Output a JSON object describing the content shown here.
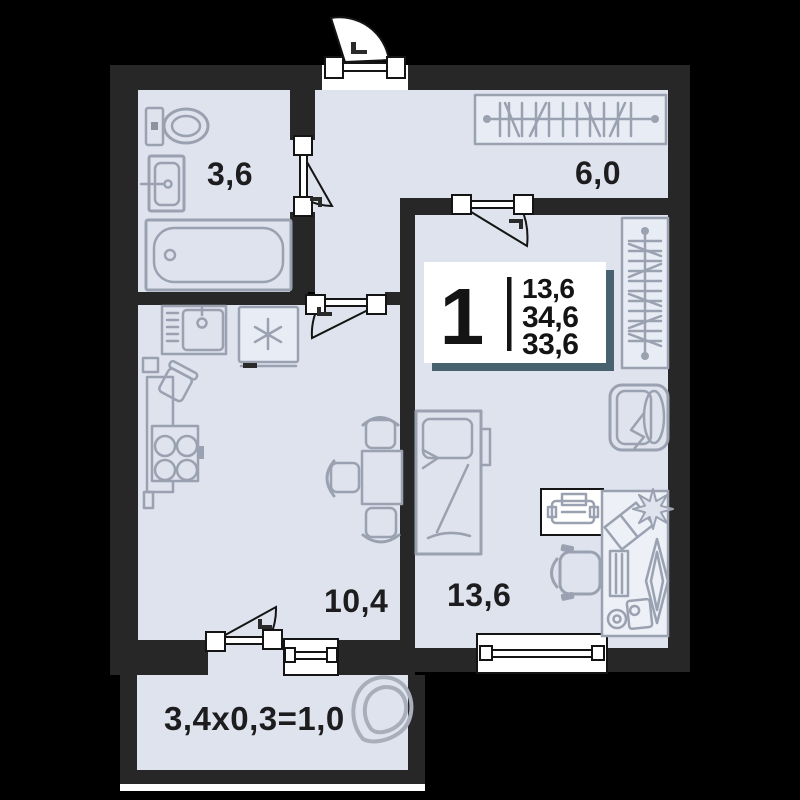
{
  "info_card": {
    "rooms_count": "1",
    "areas": [
      "13,6",
      "34,6",
      "33,6"
    ]
  },
  "rooms": {
    "bathroom": {
      "label": "3,6"
    },
    "hallway": {
      "label": "6,0"
    },
    "kitchen_living": {
      "label": "10,4"
    },
    "bedroom": {
      "label": "13,6"
    },
    "balcony": {
      "label": "3,4x0,3=1,0"
    }
  },
  "colors": {
    "background": "#000000",
    "wall": "#272727",
    "floor": "#dfe3ed",
    "furniture_stroke": "#9aa2b1",
    "furniture_fill_light": "#e8ecf4",
    "symbol_stroke": "#141414",
    "card_shadow": "#47626e",
    "card_background": "#ffffff",
    "text": "#1d1d1f"
  }
}
